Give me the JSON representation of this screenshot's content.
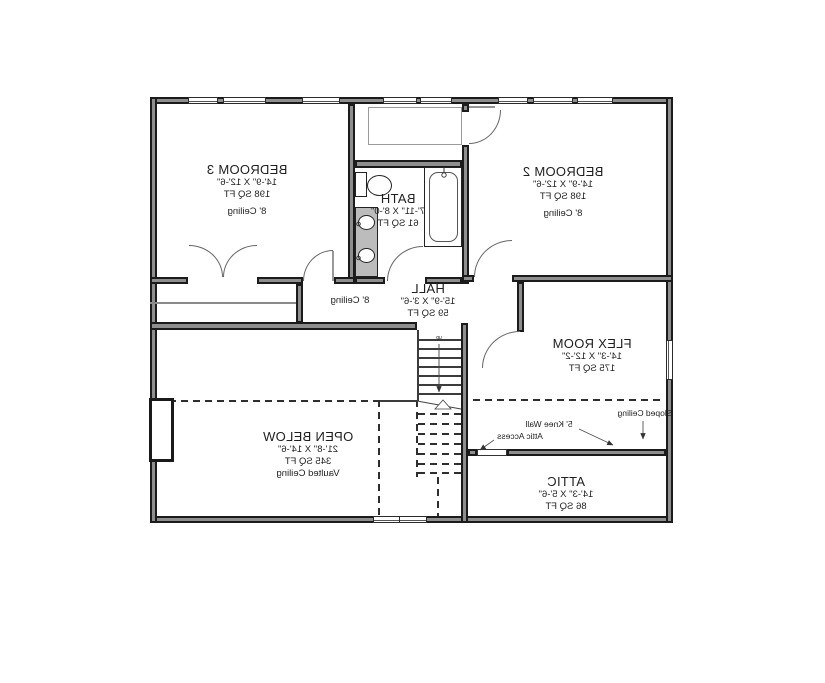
{
  "rooms": {
    "bedroom3": {
      "name": "BEDROOM 3",
      "dims": "14'-9\" X 12'-6\"",
      "area": "198 SQ FT",
      "ceiling": "8' Ceiling"
    },
    "bedroom2": {
      "name": "BEDROOM 2",
      "dims": "14'-9\" X 12'-6\"",
      "area": "198 SQ FT",
      "ceiling": "8' Ceiling"
    },
    "bath": {
      "name": "BATH",
      "dims": "7'-11\" X 8'-0\"",
      "area": "61 SQ FT"
    },
    "hall": {
      "name": "HALL",
      "dims": "15'-9\" X 3'-6\"",
      "area": "59 SQ FT",
      "ceiling": "8' Ceiling"
    },
    "flex": {
      "name": "FLEX ROOM",
      "dims": "14'-3\" X 12'-2\"",
      "area": "175 SQ FT"
    },
    "open_below": {
      "name": "OPEN BELOW",
      "dims": "21'-8\" X 14'-6\"",
      "area": "345 SQ FT",
      "ceiling": "Vaulted Ceiling"
    },
    "attic": {
      "name": "ATTIC",
      "dims": "14'-3\" X 5'-6\"",
      "area": "86 SQ FT"
    }
  },
  "annotations": {
    "sloped_ceiling": "Sloped Ceiling",
    "knee_wall": "5' Knee Wall",
    "attic_access": "Attic Access",
    "stair_direction": "up"
  },
  "colors": {
    "wall_fill": "#8e8e8e",
    "line": "#1b1b1b",
    "background": "#ffffff"
  }
}
